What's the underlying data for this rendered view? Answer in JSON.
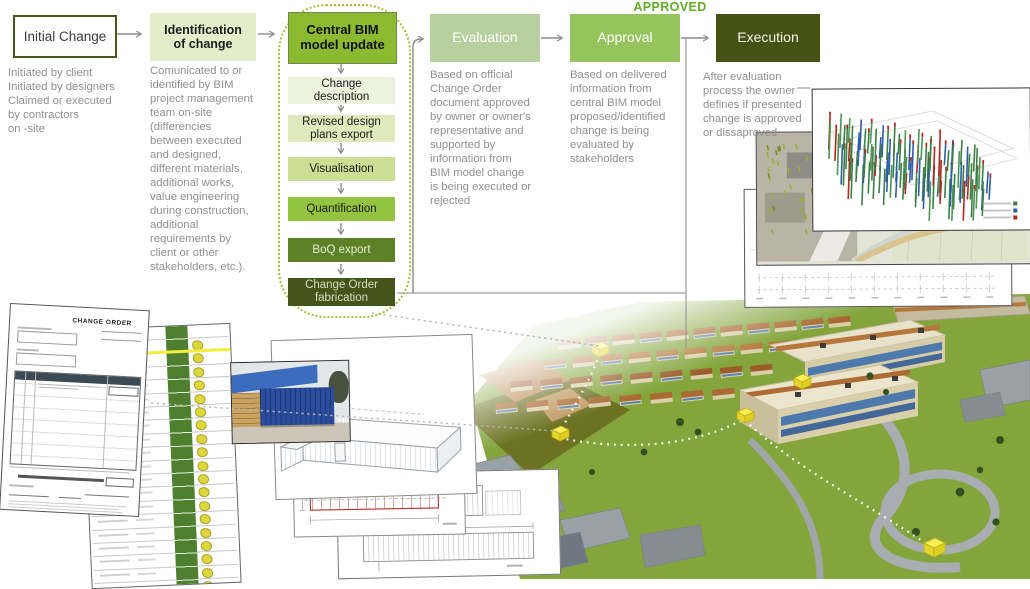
{
  "flow": {
    "approved_label": "APPROVED",
    "stages": [
      {
        "label": "Initial Change",
        "desc": "Initiated by client\nInitiated by designers\nClaimed or executed\nby contractors\non -site"
      },
      {
        "label": "Identification\nof change",
        "desc": "Comunicated to or\nidentified by BIM\nproject management\nteam on-site\n(differencies\nbetween executed\nand designed,\ndifferent materials,\nadditional works,\nvalue engineering\nduring construction,\nadditional\nrequirements by\nclient or other\nstakeholders, etc.)."
      },
      {
        "label": "Central BIM\nmodel update"
      },
      {
        "label": "Evaluation",
        "desc": "Based on official\nChange Order\ndocument approved\nby owner or owner's\nrepresentative and\nsupported by\ninformation from\nBIM model change\nis being executed or\nrejected"
      },
      {
        "label": "Approval",
        "desc": "Based on delivered\ninformation from\ncentral BIM model\nproposed/identified\nchange is being\nevaluated by\nstakeholders"
      },
      {
        "label": "Execution",
        "desc": "After evaluation\nprocess the owner\ndefines if presented\nchange is approved\nor dissaproved"
      }
    ],
    "substeps": [
      "Change\ndescription",
      "Revised design\nplans export",
      "Visualisation",
      "Quantification",
      "BoQ export",
      "Change Order\nfabrication"
    ]
  },
  "images": {
    "change_order_doc": {
      "title": "CHANGE ORDER"
    },
    "containers_photo": {
      "logo": "FiHi"
    }
  },
  "colors": {
    "accent_green": "#8bb92f",
    "pale_green": "#e4edc9",
    "evaluation_green": "#b7d09d",
    "approval_green": "#94c45b",
    "dark_olive": "#455214",
    "approved_text": "#5fae27",
    "connector_gray": "#8c8c8c",
    "substep_shades": [
      "#edf2dc",
      "#dfe9bc",
      "#cadf93",
      "#93c43f",
      "#5d8126",
      "#44551c"
    ]
  }
}
